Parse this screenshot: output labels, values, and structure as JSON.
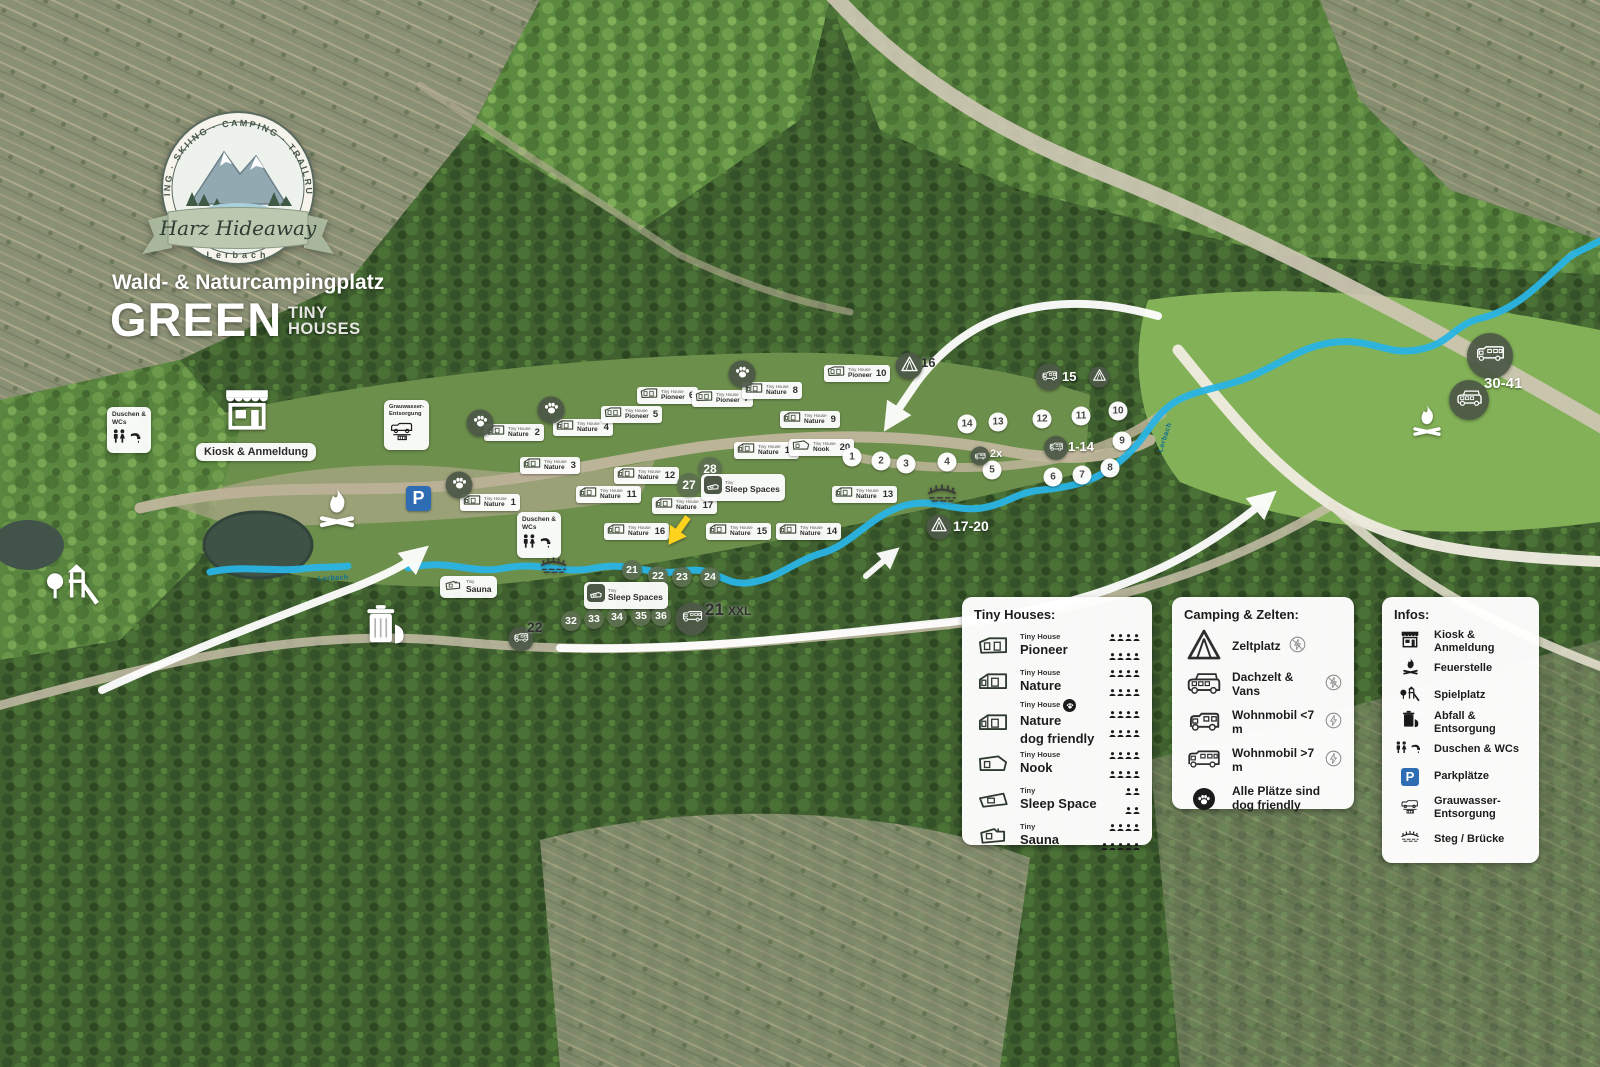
{
  "branding": {
    "ring_text": "HIKING · BIKING · SKIING · CAMPING · TRAILRUN · WALKING",
    "badge_name": "Harz Hideaway",
    "badge_sub": "Lerbach",
    "subtitle": "Wald- & Naturcampingplatz",
    "title": "GREEN",
    "title_suffix_line1": "TINY",
    "title_suffix_line2": "HOUSES"
  },
  "colors": {
    "stream": "#29b4e4",
    "badge_dark": "#4d5747",
    "green_circle": "#5d7050",
    "parking_blue": "#2e6cb4",
    "arrow_yellow": "#ffd21e"
  },
  "map": {
    "tiny_house_label_small": "Tiny House",
    "tiny_label_small": "Tiny",
    "parking_letter": "P",
    "houses": [
      {
        "num": "1",
        "type": "Nature",
        "x": 460,
        "y": 494
      },
      {
        "num": "2",
        "type": "Nature",
        "x": 484,
        "y": 424
      },
      {
        "num": "3",
        "type": "Nature",
        "x": 520,
        "y": 457
      },
      {
        "num": "4",
        "type": "Nature",
        "x": 553,
        "y": 419
      },
      {
        "num": "5",
        "type": "Pioneer",
        "x": 601,
        "y": 406
      },
      {
        "num": "6",
        "type": "Pioneer",
        "x": 637,
        "y": 387
      },
      {
        "num": "7",
        "type": "Pioneer",
        "x": 692,
        "y": 390
      },
      {
        "num": "8",
        "type": "Nature",
        "x": 742,
        "y": 382
      },
      {
        "num": "9",
        "type": "Nature",
        "x": 780,
        "y": 411
      },
      {
        "num": "10",
        "type": "Pioneer",
        "x": 824,
        "y": 365
      },
      {
        "num": "11",
        "type": "Nature",
        "x": 576,
        "y": 486
      },
      {
        "num": "12",
        "type": "Nature",
        "x": 614,
        "y": 467
      },
      {
        "num": "13",
        "type": "Nature",
        "x": 832,
        "y": 486
      },
      {
        "num": "14",
        "type": "Nature",
        "x": 776,
        "y": 523
      },
      {
        "num": "15",
        "type": "Nature",
        "x": 706,
        "y": 523
      },
      {
        "num": "16",
        "type": "Nature",
        "x": 604,
        "y": 523
      },
      {
        "num": "17",
        "type": "Nature",
        "x": 652,
        "y": 497
      },
      {
        "num": "19",
        "type": "Nature",
        "x": 734,
        "y": 442
      },
      {
        "num": "20",
        "type": "Nook",
        "x": 789,
        "y": 439
      }
    ],
    "paws": [
      {
        "x": 480,
        "y": 423
      },
      {
        "x": 551,
        "y": 410
      },
      {
        "x": 459,
        "y": 485
      },
      {
        "x": 742,
        "y": 374
      }
    ],
    "site_circles": [
      {
        "n": "1",
        "x": 852,
        "y": 457
      },
      {
        "n": "2",
        "x": 881,
        "y": 461
      },
      {
        "n": "3",
        "x": 906,
        "y": 464
      },
      {
        "n": "4",
        "x": 947,
        "y": 462
      },
      {
        "n": "5",
        "x": 992,
        "y": 470
      },
      {
        "n": "6",
        "x": 1053,
        "y": 477
      },
      {
        "n": "7",
        "x": 1082,
        "y": 475
      },
      {
        "n": "8",
        "x": 1110,
        "y": 468
      },
      {
        "n": "9",
        "x": 1122,
        "y": 441
      },
      {
        "n": "10",
        "x": 1118,
        "y": 411
      },
      {
        "n": "11",
        "x": 1081,
        "y": 416
      },
      {
        "n": "12",
        "x": 1042,
        "y": 419
      },
      {
        "n": "13",
        "x": 998,
        "y": 422
      },
      {
        "n": "14",
        "x": 967,
        "y": 424
      }
    ],
    "green_circles": [
      {
        "n": "21",
        "x": 632,
        "y": 570,
        "d": 20
      },
      {
        "n": "22",
        "x": 658,
        "y": 576,
        "d": 20
      },
      {
        "n": "23",
        "x": 682,
        "y": 577,
        "d": 20
      },
      {
        "n": "24",
        "x": 710,
        "y": 577,
        "d": 20
      },
      {
        "n": "27",
        "x": 689,
        "y": 485,
        "d": 24
      },
      {
        "n": "28",
        "x": 710,
        "y": 469,
        "d": 24
      },
      {
        "n": "32",
        "x": 571,
        "y": 621,
        "d": 20
      },
      {
        "n": "33",
        "x": 594,
        "y": 619,
        "d": 20
      },
      {
        "n": "34",
        "x": 617,
        "y": 617,
        "d": 20
      },
      {
        "n": "35",
        "x": 641,
        "y": 616,
        "d": 20
      },
      {
        "n": "36",
        "x": 661,
        "y": 616,
        "d": 20
      }
    ],
    "badges": [
      {
        "icon": "tent",
        "x": 909,
        "y": 366,
        "d": 27
      },
      {
        "icon": "camper",
        "x": 1049,
        "y": 377,
        "d": 27
      },
      {
        "icon": "tent",
        "x": 1099,
        "y": 377,
        "d": 21
      },
      {
        "icon": "camper",
        "x": 1056,
        "y": 448,
        "d": 24
      },
      {
        "icon": "camper",
        "x": 980,
        "y": 456,
        "d": 19
      },
      {
        "icon": "tent",
        "x": 939,
        "y": 527,
        "d": 25
      },
      {
        "icon": "camper",
        "x": 521,
        "y": 639,
        "d": 25
      },
      {
        "icon": "camper-big",
        "x": 692,
        "y": 619,
        "d": 33
      },
      {
        "icon": "camper-big",
        "x": 1490,
        "y": 356,
        "d": 46
      },
      {
        "icon": "van",
        "x": 1469,
        "y": 400,
        "d": 40
      }
    ],
    "badge_texts": [
      {
        "t": "16",
        "x": 921,
        "y": 356,
        "fs": 13,
        "c": "dark"
      },
      {
        "t": "15",
        "x": 1062,
        "y": 370,
        "fs": 13,
        "c": "white"
      },
      {
        "t": "1-14",
        "x": 1068,
        "y": 440,
        "fs": 13,
        "c": "white"
      },
      {
        "t": "2x",
        "x": 990,
        "y": 449,
        "fs": 11,
        "c": "white"
      },
      {
        "t": "17-20",
        "x": 953,
        "y": 519,
        "fs": 14,
        "c": "white"
      },
      {
        "t": "22",
        "x": 527,
        "y": 620,
        "fs": 14,
        "c": "dark"
      },
      {
        "t": "21",
        "x": 705,
        "y": 601,
        "fs": 17,
        "c": "dark"
      },
      {
        "t": "XXL",
        "x": 728,
        "y": 605,
        "fs": 12,
        "c": "dark"
      },
      {
        "t": "30-41",
        "x": 1484,
        "y": 376,
        "fs": 15,
        "c": "white"
      }
    ],
    "label_pills": [
      {
        "t": "Kiosk & Anmeldung",
        "x": 196,
        "y": 443
      }
    ],
    "wc_boxes": [
      {
        "x": 107,
        "y": 407,
        "lines": [
          "Duschen &",
          "WCs"
        ]
      },
      {
        "x": 517,
        "y": 512,
        "lines": [
          "Duschen &",
          "WCs"
        ]
      }
    ],
    "grey_boxes": [
      {
        "x": 384,
        "y": 400,
        "lines": [
          "Grauwasser-",
          "Entsorgung"
        ]
      }
    ],
    "mini_pills": [
      {
        "icon": "sauna",
        "small": "Tiny",
        "name": "Sauna",
        "x": 440,
        "y": 576
      },
      {
        "icon": "sleep",
        "small": "Tiny",
        "name": "Sleep Spaces",
        "x": 701,
        "y": 474
      },
      {
        "icon": "sleep",
        "small": "Tiny",
        "name": "Sleep Spaces",
        "x": 584,
        "y": 582
      }
    ],
    "facilities": [
      {
        "icon": "kiosk",
        "x": 222,
        "y": 386,
        "s": 50,
        "c": "#ffffff"
      },
      {
        "icon": "campfire",
        "x": 317,
        "y": 486,
        "s": 40,
        "c": "#ffffff"
      },
      {
        "icon": "campfire",
        "x": 1411,
        "y": 403,
        "s": 32,
        "c": "#ffffff"
      },
      {
        "icon": "trash",
        "x": 365,
        "y": 603,
        "s": 40,
        "c": "#ffffff"
      },
      {
        "icon": "playground",
        "x": 46,
        "y": 558,
        "s": 54,
        "c": "#ffffff"
      },
      {
        "icon": "bridge",
        "x": 926,
        "y": 483,
        "s": 32,
        "c": "#3a3a3a"
      },
      {
        "icon": "bridge",
        "x": 539,
        "y": 556,
        "s": 29,
        "c": "#3a3a3a"
      },
      {
        "icon": "arrow-yellow",
        "x": 662,
        "y": 512,
        "s": 32,
        "c": "#ffd21e"
      }
    ],
    "parking": {
      "x": 406,
      "y": 486,
      "s": 25
    },
    "stream_labels": [
      {
        "t": "Lerbach",
        "x": 318,
        "y": 575,
        "rot": -3,
        "fs": 7
      },
      {
        "t": "Lerbach",
        "x": 1150,
        "y": 434,
        "rot": -72,
        "fs": 7
      }
    ]
  },
  "legend": {
    "tiny": {
      "title": "Tiny Houses:",
      "items": [
        {
          "icon": "th-pioneer",
          "small": "Tiny House",
          "name": "Pioneer",
          "cap": [
            4,
            4
          ]
        },
        {
          "icon": "th-nature",
          "small": "Tiny House",
          "name": "Nature",
          "cap": [
            4,
            4
          ]
        },
        {
          "icon": "th-nature",
          "small": "Tiny House",
          "name": "Nature",
          "name2": "dog friendly",
          "paw": true,
          "cap": [
            4,
            4
          ]
        },
        {
          "icon": "th-nook",
          "small": "Tiny House",
          "name": "Nook",
          "cap": [
            4,
            4
          ]
        },
        {
          "icon": "th-sleep",
          "small": "Tiny",
          "name": "Sleep Space",
          "cap": [
            2,
            2
          ]
        },
        {
          "icon": "th-sauna",
          "small": "Tiny",
          "name": "Sauna",
          "cap": [
            4,
            5
          ]
        }
      ]
    },
    "camping": {
      "title": "Camping & Zelten:",
      "items": [
        {
          "icon": "tent",
          "label": "Zeltplatz",
          "power": false
        },
        {
          "icon": "van",
          "label": "Dachzelt & Vans",
          "power": false
        },
        {
          "icon": "camper",
          "label": "Wohnmobil <7 m",
          "power": true
        },
        {
          "icon": "camper-big",
          "label": "Wohnmobil >7 m",
          "power": true
        },
        {
          "icon": "paw-badge",
          "label": "Alle Plätze sind\ndog friendly"
        }
      ]
    },
    "infos": {
      "title": "Infos:",
      "items": [
        {
          "icon": "kiosk",
          "label": "Kiosk & Anmeldung"
        },
        {
          "icon": "campfire",
          "label": "Feuerstelle"
        },
        {
          "icon": "playground",
          "label": "Spielplatz"
        },
        {
          "icon": "trash",
          "label": "Abfall & Entsorgung"
        },
        {
          "icon": "wc",
          "label": "Duschen & WCs"
        },
        {
          "icon": "parking",
          "label": "Parkplätze"
        },
        {
          "icon": "greywater",
          "label": "Grauwasser-\nEntsorgung"
        },
        {
          "icon": "bridge",
          "label": "Steg / Brücke"
        }
      ]
    }
  }
}
